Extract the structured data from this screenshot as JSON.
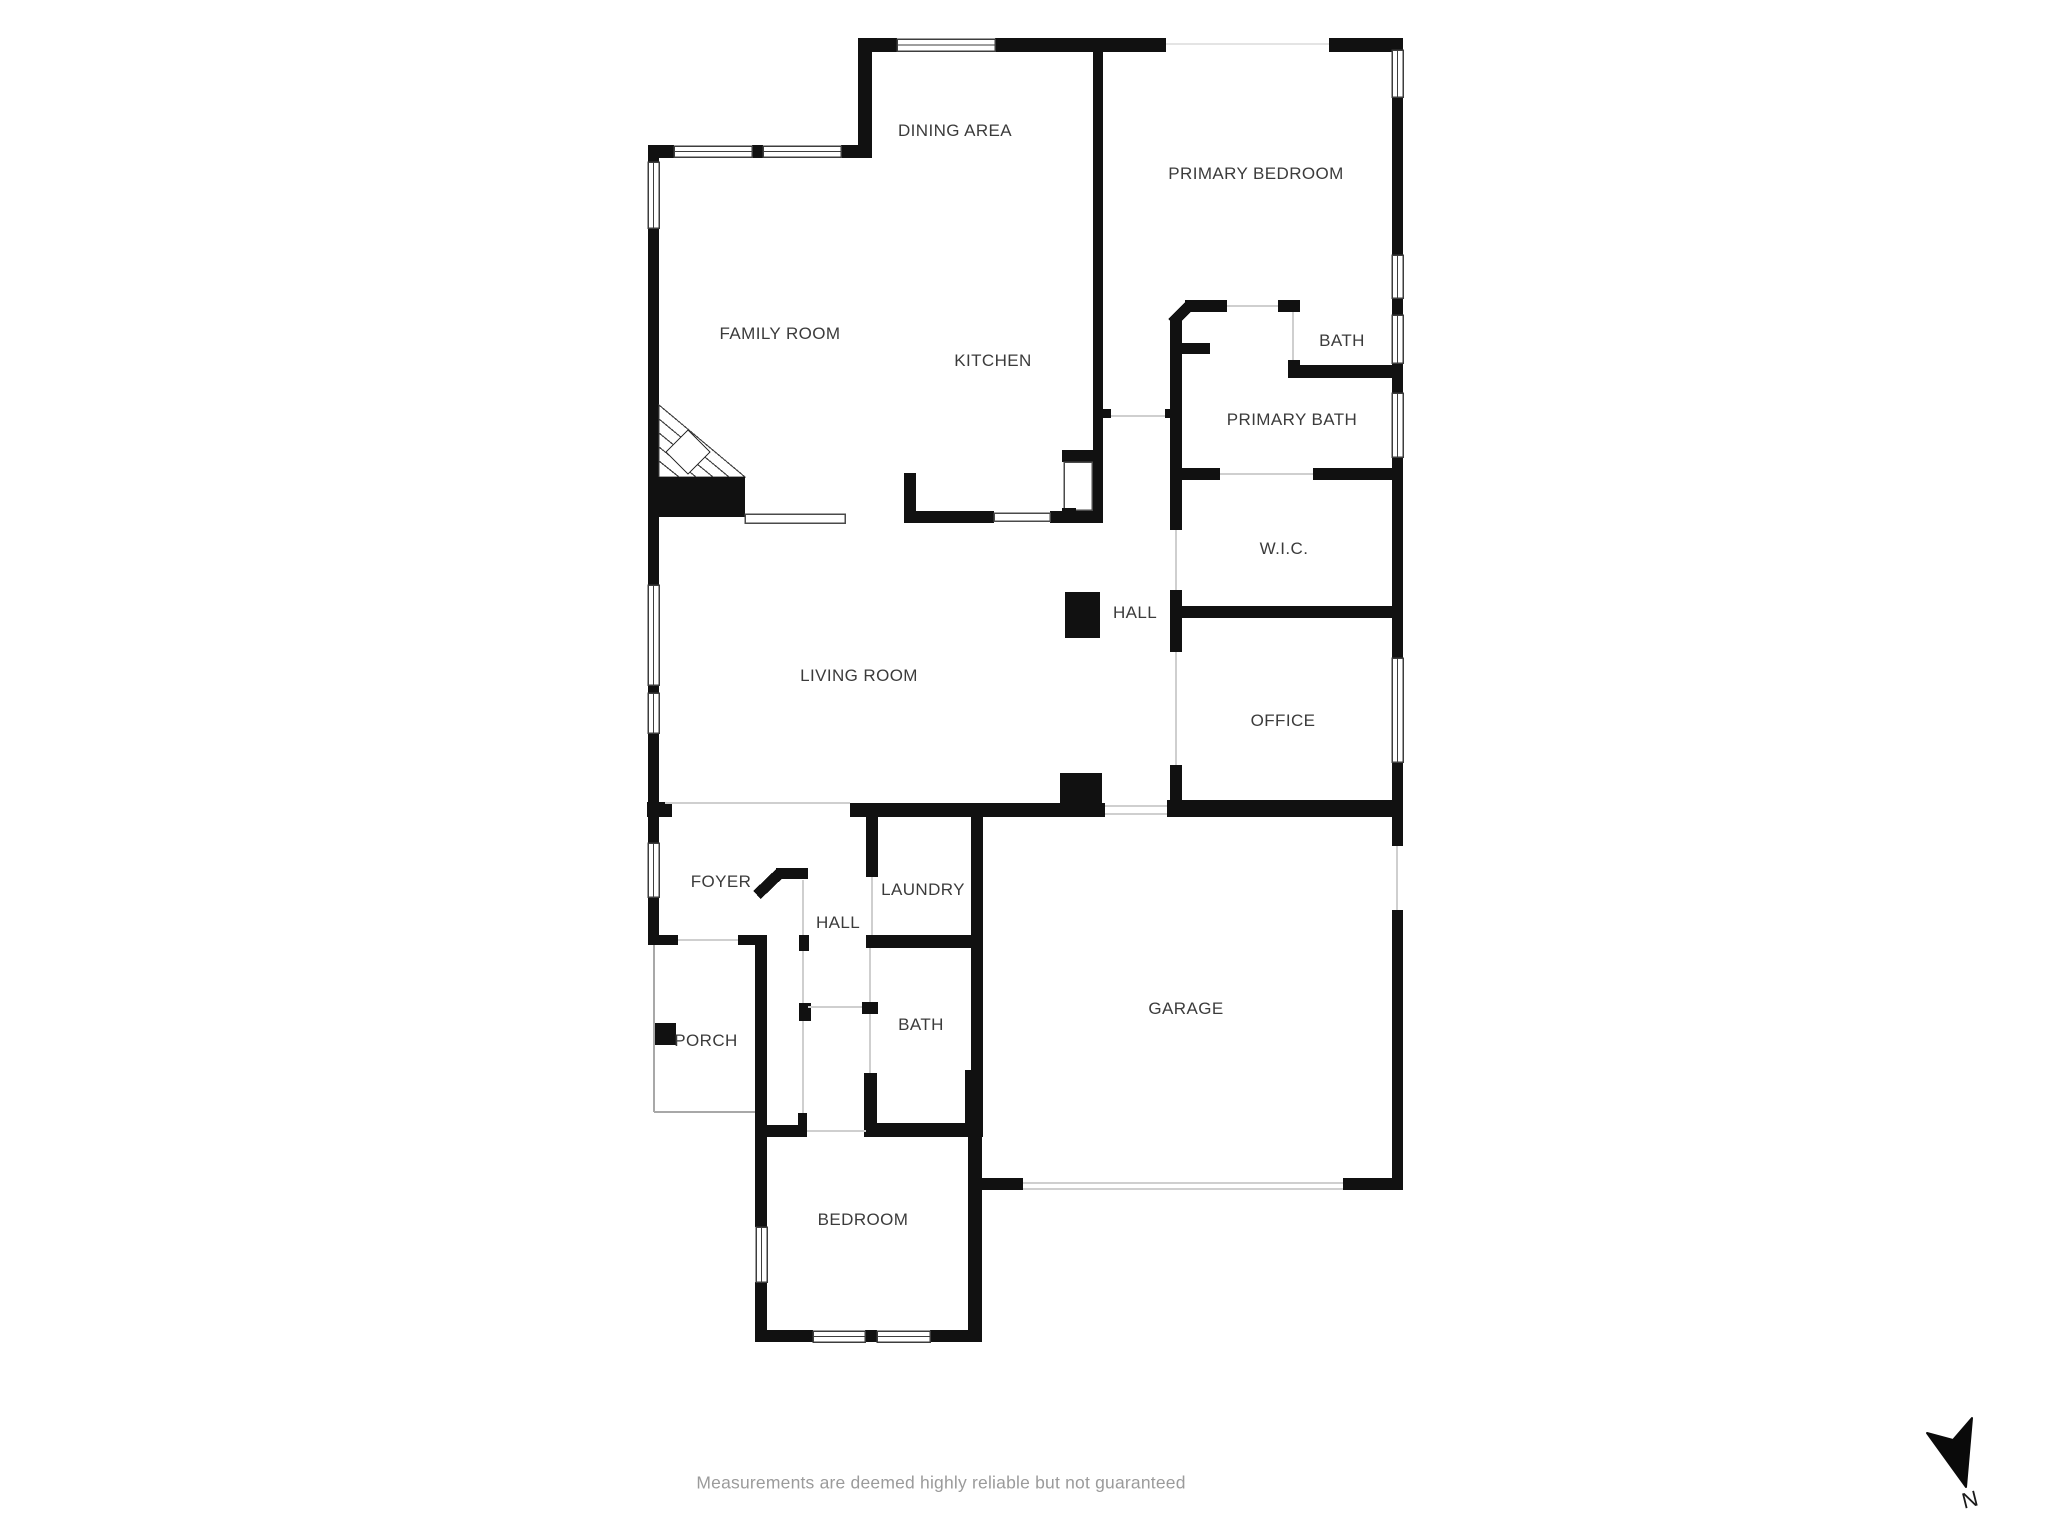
{
  "floor_plan": {
    "rooms": [
      {
        "label": "DINING AREA"
      },
      {
        "label": "PRIMARY BEDROOM"
      },
      {
        "label": "FAMILY ROOM"
      },
      {
        "label": "KITCHEN"
      },
      {
        "label": "BATH"
      },
      {
        "label": "PRIMARY BATH"
      },
      {
        "label": "W.I.C."
      },
      {
        "label": "HALL"
      },
      {
        "label": "LIVING ROOM"
      },
      {
        "label": "OFFICE"
      },
      {
        "label": "FOYER"
      },
      {
        "label": "HALL"
      },
      {
        "label": "LAUNDRY"
      },
      {
        "label": "BATH"
      },
      {
        "label": "PORCH"
      },
      {
        "label": "GARAGE"
      },
      {
        "label": "BEDROOM"
      }
    ],
    "disclaimer": "Measurements are deemed highly reliable but not guaranteed",
    "compass": {
      "label": "N"
    },
    "colors": {
      "wall": "#111111",
      "opening_line": "#cfcfcf",
      "window_frame": "#3d3d3d",
      "label_text": "#3b3b3b",
      "disclaimer_text": "#9b9b9b",
      "background": "#ffffff"
    }
  }
}
